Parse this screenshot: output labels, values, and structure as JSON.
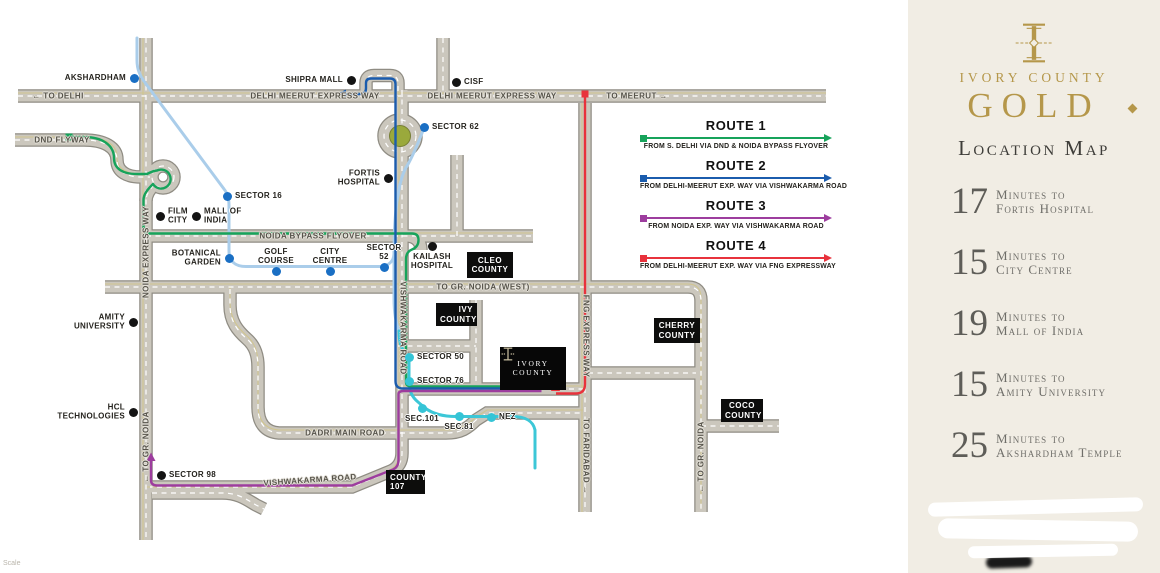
{
  "sidebar": {
    "brand_line": "IVORY COUNTY",
    "brand_main": "GOLD",
    "section_title": "Location Map",
    "accent_gold": "#b5974a",
    "times": [
      {
        "minutes": "17",
        "line1": "Minutes to",
        "line2": "Fortis Hospital"
      },
      {
        "minutes": "15",
        "line1": "Minutes to",
        "line2": "City Centre"
      },
      {
        "minutes": "19",
        "line1": "Minutes to",
        "line2": "Mall of India"
      },
      {
        "minutes": "15",
        "line1": "Minutes to",
        "line2": "Amity University"
      },
      {
        "minutes": "25",
        "line1": "Minutes to",
        "line2": "Akshardham Temple"
      }
    ]
  },
  "legend": {
    "routes": [
      {
        "name": "ROUTE 1",
        "desc": "FROM S. DELHI VIA DND & NOIDA BYPASS FLYOVER",
        "color": "#17a35b"
      },
      {
        "name": "ROUTE 2",
        "desc": "FROM DELHI-MEERUT EXP. WAY VIA VISHWAKARMA ROAD",
        "color": "#1b5cad"
      },
      {
        "name": "ROUTE 3",
        "desc": "FROM NOIDA EXP. WAY VIA VISHWAKARMA ROAD",
        "color": "#9d3d9e"
      },
      {
        "name": "ROUTE 4",
        "desc": "FROM DELHI-MEERUT EXP. WAY VIA FNG EXPRESSWAY",
        "color": "#e8323c"
      }
    ]
  },
  "map": {
    "scale_note": "Scale",
    "roundabout_color": "#9aa93c",
    "metro": {
      "light_blue": "#aacdea",
      "teal": "#3cc7d7"
    },
    "dot_colors": {
      "black": "#141414",
      "blue": "#1a6fc4",
      "teal": "#35c4d6"
    },
    "site": {
      "line1": "IVORY",
      "line2": "COUNTY"
    },
    "road_labels": [
      {
        "text": "← TO DELHI",
        "x": 58,
        "y": 96,
        "rot": 0
      },
      {
        "text": "DELHI MEERUT EXPRESS WAY",
        "x": 315,
        "y": 96,
        "rot": 0
      },
      {
        "text": "DELHI MEERUT EXPRESS WAY",
        "x": 492,
        "y": 96,
        "rot": 0
      },
      {
        "text": "TO MEERUT →",
        "x": 637,
        "y": 96,
        "rot": 0
      },
      {
        "text": "DND FLYWAY",
        "x": 62,
        "y": 140,
        "rot": 0
      },
      {
        "text": "NOIDA BYPASS FLYOVER",
        "x": 313,
        "y": 236,
        "rot": 0
      },
      {
        "text": "TO GR. NOIDA (WEST)",
        "x": 483,
        "y": 287,
        "rot": 0
      },
      {
        "text": "DADRI MAIN ROAD",
        "x": 345,
        "y": 433,
        "rot": 0
      },
      {
        "text": "VISHWAKARMA ROAD",
        "x": 310,
        "y": 480,
        "rot": -4
      },
      {
        "text": "NOIDA EXPRESS WAY",
        "x": 146,
        "y": 252,
        "rot": -90
      },
      {
        "text": "← TO GR. NOIDA",
        "x": 146,
        "y": 447,
        "rot": -90
      },
      {
        "text": "VISHWAKARMA ROAD",
        "x": 403,
        "y": 328,
        "rot": 90
      },
      {
        "text": "FNG EXPRESS WAY",
        "x": 586,
        "y": 336,
        "rot": 90
      },
      {
        "text": "TO FARIDABAD →",
        "x": 586,
        "y": 456,
        "rot": 90
      },
      {
        "text": "← TO GR. NOIDA",
        "x": 701,
        "y": 457,
        "rot": -90
      }
    ],
    "pois": [
      {
        "lines": [
          "AKSHARDHAM"
        ],
        "x": 134,
        "y": 78,
        "dot": "blue",
        "side": "left"
      },
      {
        "lines": [
          "SHIPRA MALL"
        ],
        "x": 351,
        "y": 80,
        "dot": "black",
        "side": "left"
      },
      {
        "lines": [
          "CISF"
        ],
        "x": 456,
        "y": 82,
        "dot": "black",
        "side": "right"
      },
      {
        "lines": [
          "SECTOR 62"
        ],
        "x": 424,
        "y": 127,
        "dot": "blue",
        "side": "right"
      },
      {
        "lines": [
          "SECTOR 16"
        ],
        "x": 227,
        "y": 196,
        "dot": "blue",
        "side": "right"
      },
      {
        "lines": [
          "FILM",
          "CITY"
        ],
        "x": 160,
        "y": 216,
        "dot": "black",
        "side": "right"
      },
      {
        "lines": [
          "MALL OF",
          "INDIA"
        ],
        "x": 196,
        "y": 216,
        "dot": "black",
        "side": "right"
      },
      {
        "lines": [
          "FORTIS",
          "HOSPITAL"
        ],
        "x": 388,
        "y": 178,
        "dot": "black",
        "side": "left"
      },
      {
        "lines": [
          "KAILASH",
          "HOSPITAL"
        ],
        "x": 432,
        "y": 246,
        "dot": "black",
        "side": "below"
      },
      {
        "lines": [
          "BOTANICAL",
          "GARDEN"
        ],
        "x": 229,
        "y": 258,
        "dot": "blue",
        "side": "left"
      },
      {
        "lines": [
          "GOLF",
          "COURSE"
        ],
        "x": 276,
        "y": 271,
        "dot": "blue",
        "side": "above"
      },
      {
        "lines": [
          "CITY",
          "CENTRE"
        ],
        "x": 330,
        "y": 271,
        "dot": "blue",
        "side": "above"
      },
      {
        "lines": [
          "SECTOR",
          "52"
        ],
        "x": 384,
        "y": 267,
        "dot": "blue",
        "side": "above"
      },
      {
        "lines": [
          "AMITY",
          "UNIVERSITY"
        ],
        "x": 133,
        "y": 322,
        "dot": "black",
        "side": "left"
      },
      {
        "lines": [
          "HCL",
          "TECHNOLOGIES"
        ],
        "x": 133,
        "y": 412,
        "dot": "black",
        "side": "left"
      },
      {
        "lines": [
          "SECTOR 98"
        ],
        "x": 161,
        "y": 475,
        "dot": "black",
        "side": "right"
      },
      {
        "lines": [
          "SECTOR 50"
        ],
        "x": 409,
        "y": 357,
        "dot": "teal",
        "side": "right"
      },
      {
        "lines": [
          "SECTOR 76"
        ],
        "x": 409,
        "y": 381,
        "dot": "teal",
        "side": "right"
      },
      {
        "lines": [
          "SEC.101"
        ],
        "x": 422,
        "y": 408,
        "dot": "teal",
        "side": "below"
      },
      {
        "lines": [
          "SEC.81"
        ],
        "x": 459,
        "y": 416,
        "dot": "teal",
        "side": "below"
      },
      {
        "lines": [
          "NEZ"
        ],
        "x": 491,
        "y": 417,
        "dot": "teal",
        "side": "right"
      }
    ],
    "communities": [
      {
        "lines": [
          "CLEO",
          "COUNTY"
        ],
        "x": 467,
        "y": 252,
        "w": 46,
        "h": 26,
        "align": "center"
      },
      {
        "lines": [
          "IVY",
          "COUNTY"
        ],
        "x": 436,
        "y": 303,
        "w": 41,
        "h": 23,
        "align": "right"
      },
      {
        "lines": [
          "CHERRY",
          "COUNTY"
        ],
        "x": 654,
        "y": 318,
        "w": 46,
        "h": 25,
        "align": "center"
      },
      {
        "lines": [
          "COCO",
          "COUNTY"
        ],
        "x": 721,
        "y": 399,
        "w": 42,
        "h": 23,
        "align": "center"
      },
      {
        "lines": [
          "COUNTY",
          "107"
        ],
        "x": 386,
        "y": 470,
        "w": 39,
        "h": 24,
        "align": "left"
      }
    ]
  }
}
